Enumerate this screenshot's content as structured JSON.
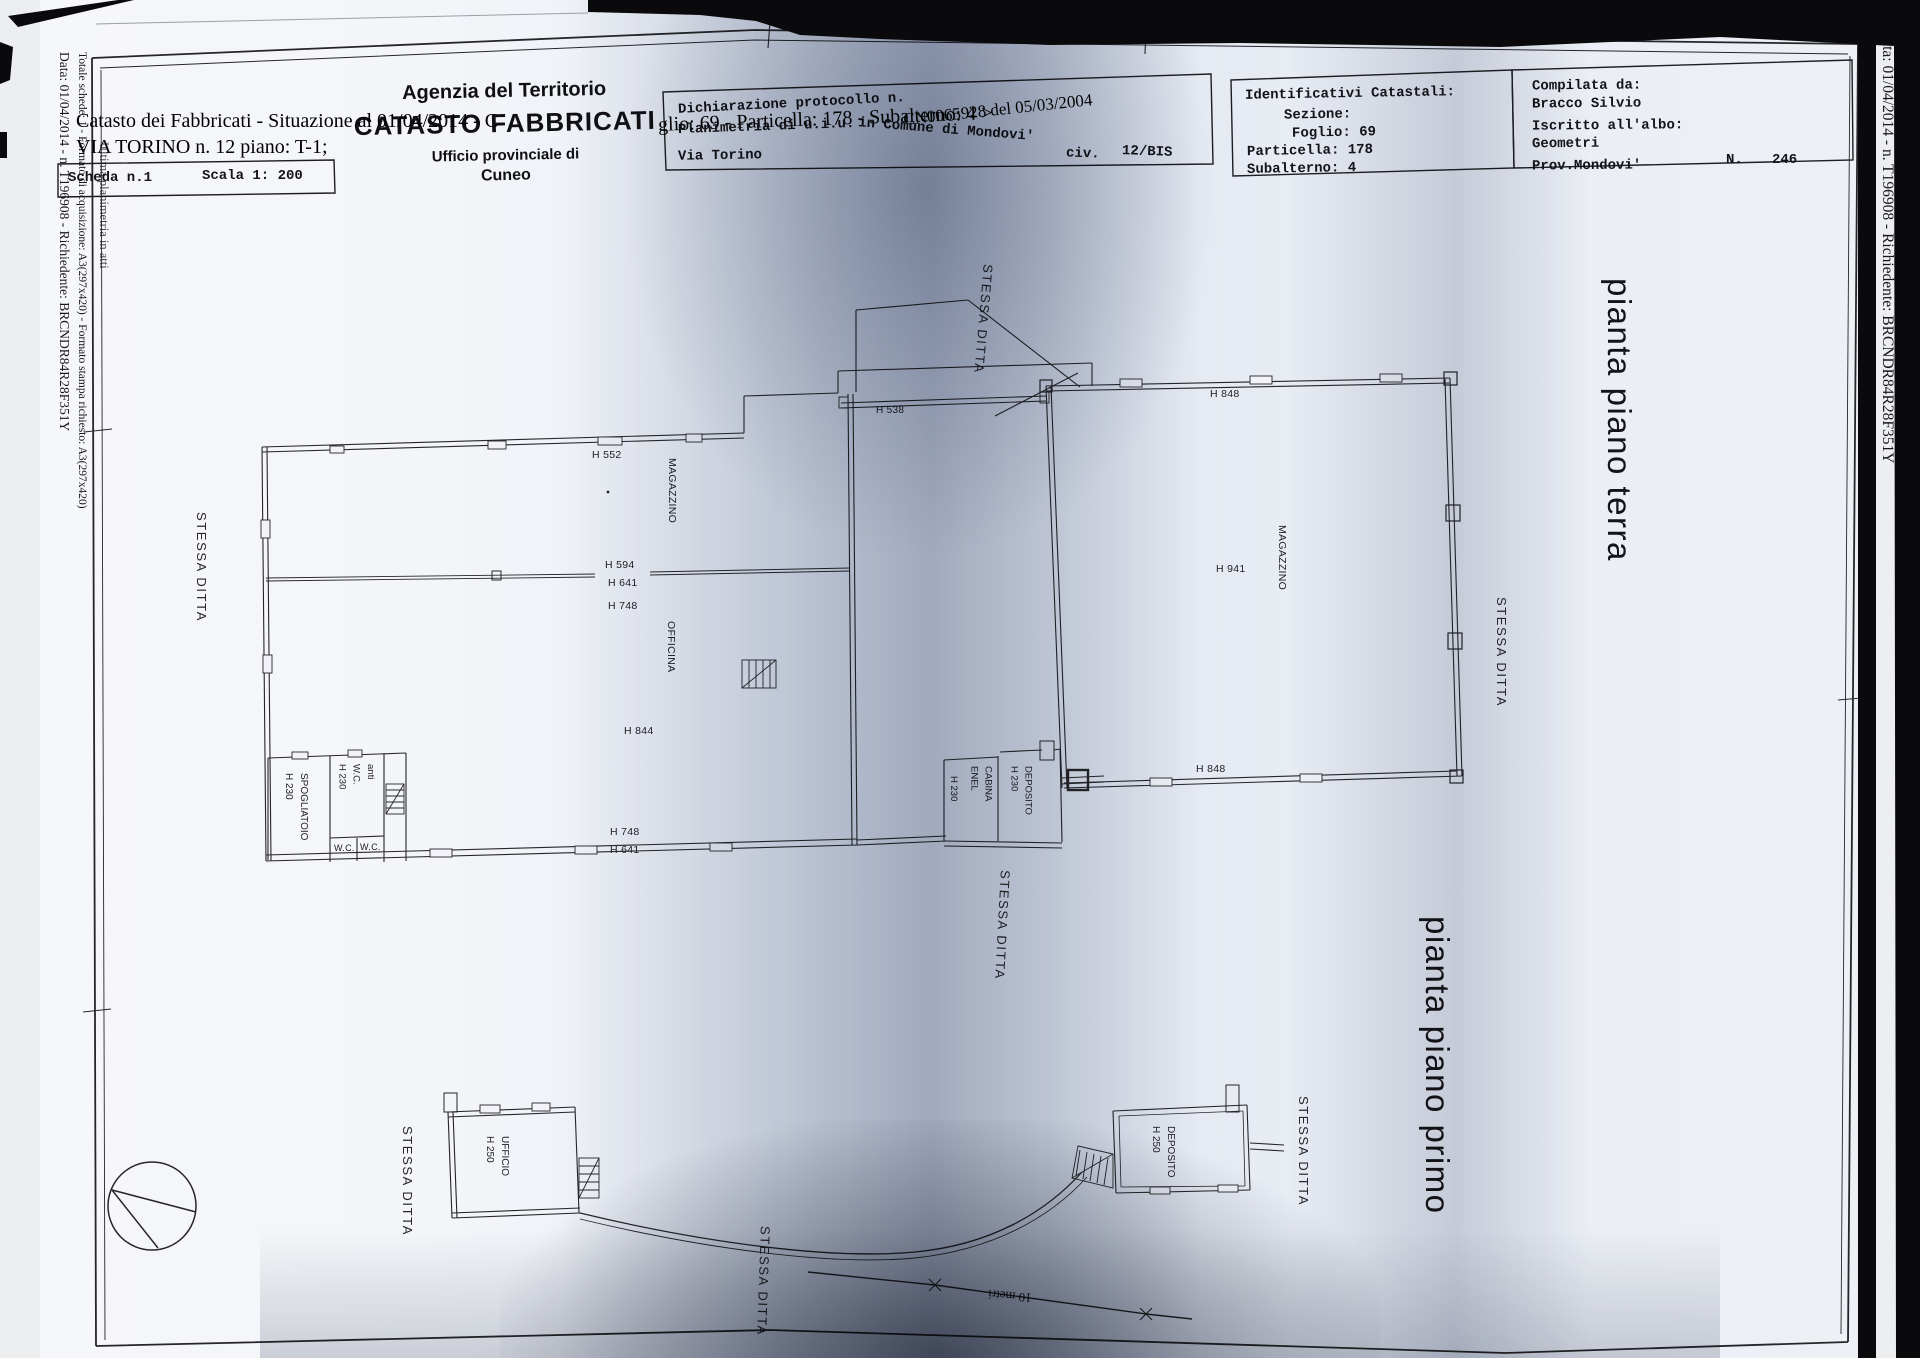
{
  "edges": {
    "left_line1": "Data: 01/04/2014 - n. T196908 - Richiedente: BRCNDR84R28F351Y",
    "left_line2": "Totale schede: 1 - Formato di acquisizione: A3(297x420) - Formato stampa richiesto: A3(297x420)",
    "left_line3": "Ultima planimetria in atti",
    "right_line": "Data: 01/04/2014 - n. T196908 - Richiedente: BRCNDR84R28F351Y"
  },
  "overlay": {
    "situazione_part1": "Catasto dei Fabbricati - Situazione al 01/04/2014 - C",
    "situazione_part2": "glio: 69 - Particella: 178 - Subalterno: 4 >",
    "address_line": "VIA TORINO n. 12 piano: T-1;",
    "scheda": "Scheda n.1",
    "scala": "Scala 1: 200",
    "protocol_overlay": "CN0065928 del 05/03/2004"
  },
  "agency": {
    "line1": "Agenzia del Territorio",
    "line2": "CATASTO FABBRICATI",
    "line3": "Ufficio provinciale di",
    "line4": "Cuneo"
  },
  "declaration": {
    "line1": "Dichiarazione protocollo n.",
    "line2a": "Planimetria di u.i.u.",
    "line2b": "in Comune di Mondovi'",
    "street": "Via Torino",
    "civ_label": "civ.",
    "civ_value": "12/BIS"
  },
  "identificativi": {
    "title": "Identificativi Catastali:",
    "sezione": "Sezione:",
    "foglio": "Foglio: 69",
    "particella": "Particella: 178",
    "subalterno": "Subalterno: 4"
  },
  "compilata": {
    "title": "Compilata da:",
    "name": "Bracco Silvio",
    "albo": "Iscritto all'albo:",
    "albo_value": "Geometri",
    "prov": "Prov.Mondovi'",
    "n_label": "N.",
    "n_value": "246"
  },
  "stessa_ditta": "STESSA DITTA",
  "ground_floor": {
    "title": "pianta piano terra",
    "labels": {
      "h552": "H 552",
      "magazzino_left": "MAGAZZINO",
      "h594": "H 594",
      "h641_mid": "H 641",
      "h748_mid": "H 748",
      "officina": "OFFICINA",
      "h844": "H 844",
      "h748_bottom": "H 748",
      "h641_bottom": "H 641",
      "h538": "H 538",
      "h848_top": "H 848",
      "h941": "H 941",
      "magazzino_right": "MAGAZZINO",
      "h848_bottom": "H 848"
    },
    "rooms": {
      "spogliatoio": [
        "SPOGLIATOIO",
        "H 230"
      ],
      "anti_wc": [
        "anti",
        "W.C.",
        "H 230"
      ],
      "wc1": "W.C.",
      "wc2": "W.C.",
      "cabina_enel": [
        "CABINA",
        "ENEL"
      ],
      "cabina_h": "H 230",
      "deposito": [
        "DEPOSITO",
        "H 230"
      ]
    }
  },
  "first_floor": {
    "title": "pianta piano primo",
    "rooms": {
      "ufficio": [
        "UFFICIO",
        "H 250"
      ],
      "deposito": [
        "DEPOSITO",
        "H 250"
      ]
    },
    "scale_label": "10 metri"
  }
}
